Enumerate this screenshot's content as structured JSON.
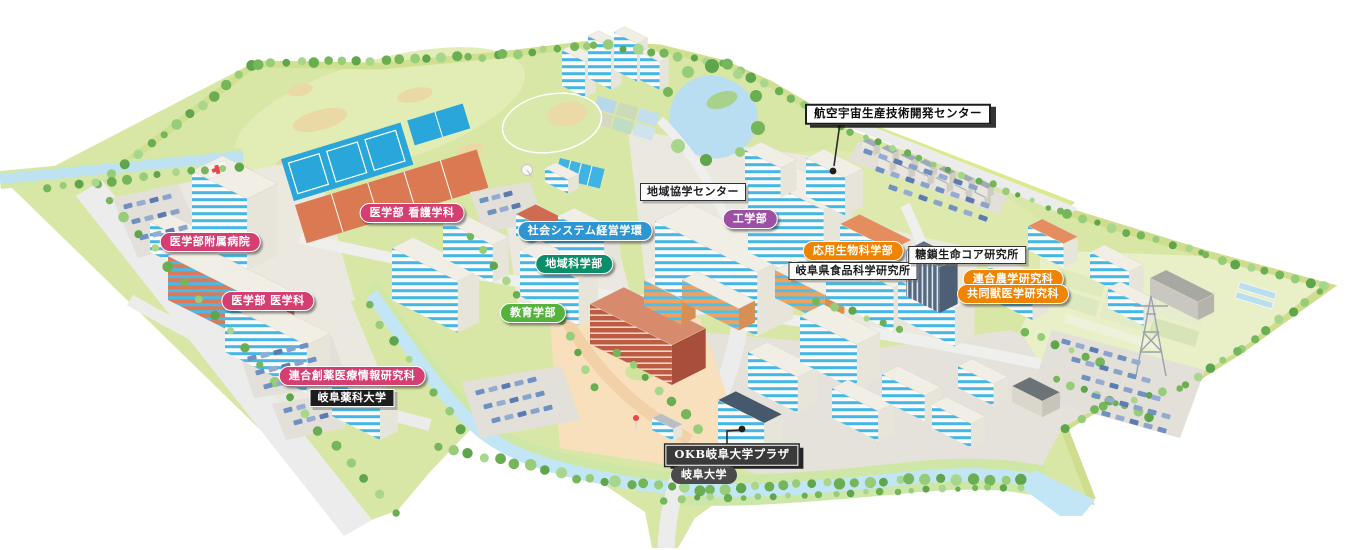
{
  "map": {
    "labels": [
      {
        "id": "hospital",
        "text": "医学部附属病院",
        "style": "pill",
        "color": "#d53e70",
        "x": 210,
        "y": 242
      },
      {
        "id": "medicine-nursing",
        "text": "医学部 看護学科",
        "style": "pill",
        "color": "#d53e70",
        "x": 412,
        "y": 213
      },
      {
        "id": "medicine-medical",
        "text": "医学部 医学科",
        "style": "pill",
        "color": "#d53e70",
        "x": 268,
        "y": 301
      },
      {
        "id": "drug-discovery",
        "text": "連合創薬医療情報研究科",
        "style": "pill",
        "color": "#d53e70",
        "x": 352,
        "y": 376
      },
      {
        "id": "gifu-pharmaceutical-university",
        "text": "岐阜薬科大学",
        "style": "box-black",
        "x": 352,
        "y": 398
      },
      {
        "id": "social-system-management",
        "text": "社会システム経営学環",
        "style": "pill",
        "color": "#2e95d3",
        "x": 585,
        "y": 231
      },
      {
        "id": "regional-science",
        "text": "地域科学部",
        "style": "pill",
        "color": "#0b8f6a",
        "x": 574,
        "y": 264
      },
      {
        "id": "education",
        "text": "教育学部",
        "style": "pill",
        "color": "#55b23c",
        "x": 533,
        "y": 313
      },
      {
        "id": "community-cooperation-center",
        "text": "地域協学センター",
        "style": "box-white",
        "x": 693,
        "y": 192
      },
      {
        "id": "engineering",
        "text": "工学部",
        "style": "pill",
        "color": "#9d4fa5",
        "x": 750,
        "y": 219
      },
      {
        "id": "applied-biological-sciences",
        "text": "応用生物科学部",
        "style": "pill",
        "color": "#f08300",
        "x": 853,
        "y": 251
      },
      {
        "id": "gifu-food-science-research-institute",
        "text": "岐阜県食品科学研究所",
        "style": "box-white",
        "x": 853,
        "y": 271
      },
      {
        "id": "glyco-core-research-institute",
        "text": "糖鎖生命コア研究所",
        "style": "box-white",
        "x": 967,
        "y": 255
      },
      {
        "id": "united-graduate-school-of-agriculture",
        "text": "連合農学研究科",
        "style": "pill",
        "color": "#f08300",
        "x": 1013,
        "y": 279
      },
      {
        "id": "joint-graduate-school-of-veterinary-medicine",
        "text": "共同獣医学研究科",
        "style": "pill",
        "color": "#f08300",
        "x": 1013,
        "y": 294
      },
      {
        "id": "aerospace-production-technology-center",
        "text": "航空宇宙生産技術開発センター",
        "style": "box-white-strong",
        "x": 898,
        "y": 114,
        "leader": {
          "points": [
            [
              840,
              123
            ],
            [
              834,
              166
            ]
          ],
          "dot": [
            833,
            171
          ]
        }
      },
      {
        "id": "okb-gifu-university-plaza",
        "text": "OKB岐阜大学プラザ",
        "style": "box-dark",
        "x": 732,
        "y": 455,
        "leader": {
          "points": [
            [
              727,
              447
            ],
            [
              727,
              431
            ],
            [
              740,
              430
            ]
          ],
          "dot": [
            742,
            429
          ]
        }
      },
      {
        "id": "gifu-university",
        "text": "岐阜大学",
        "style": "box-round-dark",
        "x": 704,
        "y": 475
      }
    ],
    "leader_color": "#2b2b2b"
  }
}
